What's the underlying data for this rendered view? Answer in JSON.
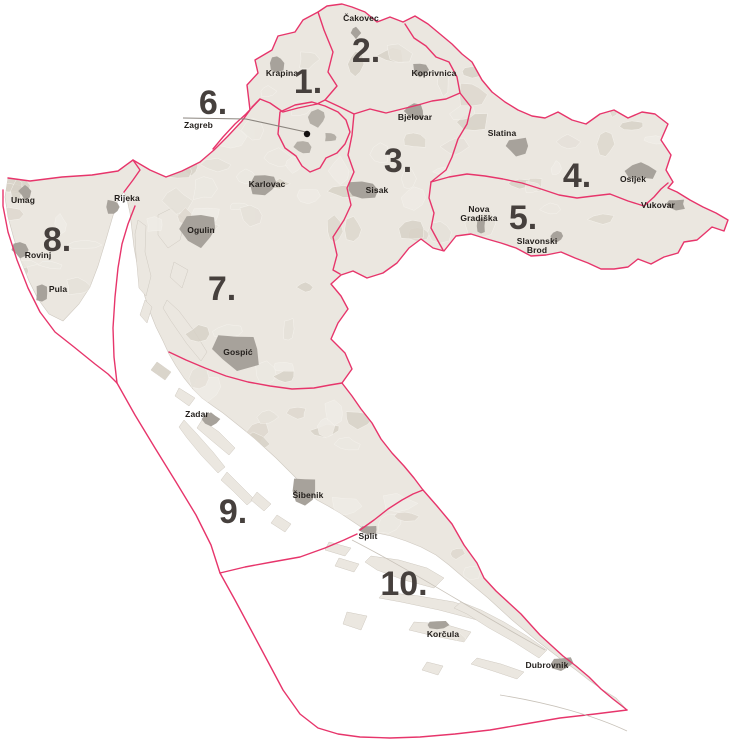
{
  "colors": {
    "pink": "#e7356b",
    "land": "#ebe7e0",
    "coast": "#cfc9c0",
    "marker": "#a7a29b",
    "number": "#46403d",
    "label": "#221e1b"
  },
  "districts": [
    {
      "label": "1.",
      "x": 308,
      "y": 93
    },
    {
      "label": "2.",
      "x": 366,
      "y": 62
    },
    {
      "label": "3.",
      "x": 398,
      "y": 172
    },
    {
      "label": "4.",
      "x": 577,
      "y": 187
    },
    {
      "label": "5.",
      "x": 523,
      "y": 229
    },
    {
      "label": "6.",
      "x": 213,
      "y": 114
    },
    {
      "label": "7.",
      "x": 222,
      "y": 300
    },
    {
      "label": "8.",
      "x": 57,
      "y": 251
    },
    {
      "label": "9.",
      "x": 233,
      "y": 523
    },
    {
      "label": "10.",
      "x": 404,
      "y": 595
    }
  ],
  "cities": [
    {
      "name": "Čakovec",
      "lines": [
        "Čakovec"
      ],
      "marker": {
        "cx": 356,
        "cy": 33,
        "rx": 5,
        "ry": 7
      }
    },
    {
      "name": "Krapina",
      "lines": [
        "Krapina"
      ],
      "marker": {
        "cx": 277,
        "cy": 63,
        "rx": 8,
        "ry": 9
      }
    },
    {
      "name": "Koprivnica",
      "lines": [
        "Koprivnica"
      ],
      "marker": {
        "cx": 420,
        "cy": 70,
        "rx": 9,
        "ry": 8
      }
    },
    {
      "name": "Bjelovar",
      "lines": [
        "Bjelovar"
      ],
      "marker": {
        "cx": 414,
        "cy": 111,
        "rx": 11,
        "ry": 10
      }
    },
    {
      "name": "Slatina",
      "lines": [
        "Slatina"
      ],
      "marker": {
        "cx": 516,
        "cy": 146,
        "rx": 12,
        "ry": 10
      }
    },
    {
      "name": "Osijek",
      "lines": [
        "Osijek"
      ],
      "marker": {
        "cx": 641,
        "cy": 171,
        "rx": 15,
        "ry": 10
      }
    },
    {
      "name": "Vukovar",
      "lines": [
        "Vukovar"
      ],
      "marker": {
        "cx": 676,
        "cy": 204,
        "rx": 11,
        "ry": 6
      }
    },
    {
      "name": "Karlovac",
      "lines": [
        "Karlovac"
      ],
      "marker": {
        "cx": 265,
        "cy": 184,
        "rx": 16,
        "ry": 13
      }
    },
    {
      "name": "Sisak",
      "lines": [
        "Sisak"
      ],
      "marker": {
        "cx": 362,
        "cy": 190,
        "rx": 19,
        "ry": 11
      }
    },
    {
      "name": "Rijeka",
      "lines": [
        "Rijeka"
      ],
      "marker": {
        "cx": 114,
        "cy": 207,
        "rx": 8,
        "ry": 9
      }
    },
    {
      "name": "Umag",
      "lines": [
        "Umag"
      ],
      "marker": {
        "cx": 25,
        "cy": 191,
        "rx": 6,
        "ry": 8
      }
    },
    {
      "name": "Rovinj",
      "lines": [
        "Rovinj"
      ],
      "marker": {
        "cx": 20,
        "cy": 250,
        "rx": 8,
        "ry": 8
      }
    },
    {
      "name": "Pula",
      "lines": [
        "Pula"
      ],
      "marker": {
        "cx": 42,
        "cy": 293,
        "rx": 8,
        "ry": 10
      }
    },
    {
      "name": "Ogulin",
      "lines": [
        "Ogulin"
      ],
      "marker": {
        "cx": 201,
        "cy": 229,
        "rx": 19,
        "ry": 17
      }
    },
    {
      "name": "Nova Gradiška",
      "lines": [
        "Nova",
        "Gradiška"
      ],
      "marker": {
        "cx": 481,
        "cy": 226,
        "rx": 5,
        "ry": 8
      }
    },
    {
      "name": "Slavonski Brod",
      "lines": [
        "Slavonski",
        "Brod"
      ],
      "marker": {
        "cx": 557,
        "cy": 236,
        "rx": 7,
        "ry": 6
      }
    },
    {
      "name": "Gospić",
      "lines": [
        "Gospić"
      ],
      "marker": {
        "cx": 237,
        "cy": 349,
        "rx": 26,
        "ry": 19
      }
    },
    {
      "name": "Zadar",
      "lines": [
        "Zadar"
      ],
      "marker": {
        "cx": 211,
        "cy": 419,
        "rx": 9,
        "ry": 7
      }
    },
    {
      "name": "Šibenik",
      "lines": [
        "Šibenik"
      ],
      "marker": {
        "cx": 305,
        "cy": 491,
        "rx": 14,
        "ry": 16
      }
    },
    {
      "name": "Split",
      "lines": [
        "Split"
      ],
      "marker": {
        "cx": 369,
        "cy": 530,
        "rx": 9,
        "ry": 5
      }
    },
    {
      "name": "Korčula",
      "lines": [
        "Korčula"
      ],
      "marker": {
        "cx": 437,
        "cy": 625,
        "rx": 11,
        "ry": 5
      }
    },
    {
      "name": "Dubrovnik",
      "lines": [
        "Dubrovnik"
      ],
      "marker": {
        "cx": 561,
        "cy": 663,
        "rx": 12,
        "ry": 7
      }
    },
    {
      "name": "Zagreb",
      "lines": [
        "Zagreb"
      ],
      "marker": {
        "cx": 307,
        "cy": 134,
        "dot": true
      }
    }
  ]
}
